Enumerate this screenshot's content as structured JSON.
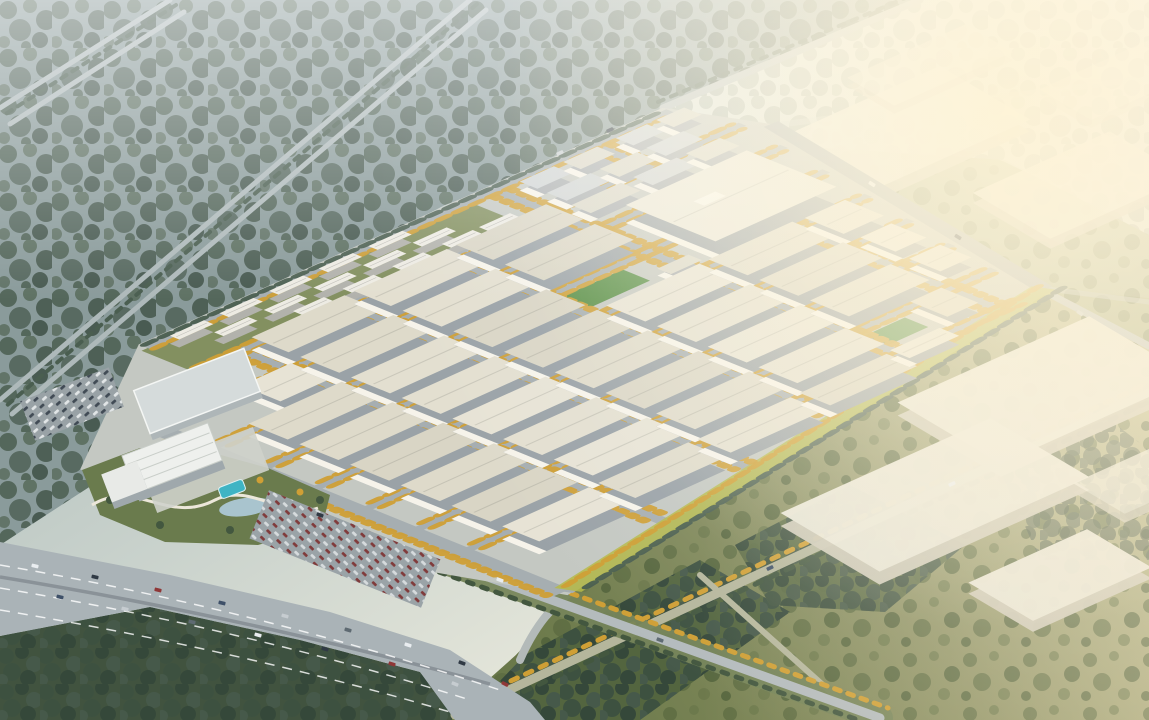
{
  "scene": {
    "description": "Aerial architectural rendering of a large industrial logistics park at hazy golden hour: grid of white warehouses with autumn street trees, residential slab apartments along the northwest edge, a hotel-office complex with pool and landscaped park at the west corner, a multi-lane highway in the foreground, misty forest to the upper left and sunlit fields with distant warehouses to the right.",
    "palette": {
      "forestBase": "#8a9b9b",
      "treeDark": "#4a5e50",
      "parkGround": "#c4c8c2",
      "street": "#a6aeb1",
      "gold": "#cf9f35",
      "chartreuse": "#b6ba48",
      "pitch": "#4e8a3d",
      "resGreen": "#7d8b58",
      "highway": "#aab3b7",
      "road": "#b4bbbd",
      "pool": "#3fb4c4",
      "sunFace": "#f6f3ea",
      "boxRoof": "#ebe8da",
      "boxFace": "#cdc9b8",
      "fieldDark": "#53653f",
      "sunGlow": "#fff5d7",
      "bld": {
        "w": {
          "name": "warehouse-building",
          "face": "#9aa2a7",
          "sun": 1,
          "roofs": [
            "#e7e3d5",
            "#dedaca",
            "#e3dfd0",
            "#d9d5c5"
          ]
        },
        "W": {
          "name": "large-warehouse-building",
          "face": "#9aa2a7",
          "sun": 1,
          "roofs": [
            "#eae7da"
          ]
        },
        "s": {
          "name": "office-building",
          "face": "#a7acb0",
          "sun": 1,
          "roofs": [
            "#d8d6c9",
            "#cdd2d4"
          ]
        },
        "r": {
          "name": "apartment-building",
          "face": "#b2b2ac",
          "sun": 0,
          "roofs": [
            "#edebe3"
          ]
        }
      }
    },
    "park": {
      "matrix": [
        62,
        -28,
        39,
        15.8,
        160,
        430
      ],
      "ground": "1.45,-2.85 9.9,-2.85 10.45,-0.8 9.35,7.8 0,10.45 -1.45,4.3 -1.35,0.1",
      "streetsU": [
        [
          -2.62,
          1.45,
          9.9,
          0.27
        ],
        [
          -1.28,
          1.3,
          10.2,
          0.2
        ],
        [
          -0.05,
          0.1,
          10.1,
          0.2
        ],
        [
          1.25,
          0.1,
          9.96,
          0.2
        ],
        [
          2.55,
          0.1,
          9.82,
          0.2
        ],
        [
          3.85,
          0.1,
          9.68,
          0.2
        ],
        [
          5.15,
          0.1,
          9.53,
          0.2
        ],
        [
          6.45,
          0.1,
          9.39,
          0.2
        ],
        [
          7.75,
          0.1,
          9.04,
          0.2
        ]
      ],
      "streetsV": [
        [
          0.0,
          0.0,
          10.3,
          0.27
        ],
        [
          2.12,
          -1.3,
          9.55,
          0.18
        ],
        [
          3.77,
          -1.3,
          9.12,
          0.18
        ],
        [
          5.42,
          -1.3,
          8.69,
          0.18
        ],
        [
          7.07,
          -2.68,
          8.26,
          0.18
        ],
        [
          8.67,
          -2.68,
          7.8,
          0.18
        ]
      ],
      "lines": [
        [
          10.42,
          -0.9,
          9.4,
          7.75,
          0.22
        ],
        [
          9.45,
          7.75,
          0.05,
          10.35,
          0.22
        ]
      ],
      "bufferLine": [
        9.42,
        7.72,
        0.1,
        10.3
      ],
      "treeLines": [
        [
          9.4,
          7.58,
          0.15,
          10.15,
          "g"
        ],
        [
          9.55,
          7.95,
          0.25,
          10.48,
          "d"
        ],
        [
          -0.16,
          0.4,
          -0.16,
          10.2,
          "g"
        ],
        [
          1.5,
          -2.52,
          9.8,
          -2.52,
          "g"
        ],
        [
          1.5,
          -2.76,
          9.85,
          -2.76,
          "d"
        ]
      ],
      "greens": [
        [
          1.35,
          -2.62,
          5.3,
          1.34,
          "g"
        ],
        [
          5.6,
          1.45,
          0.95,
          0.7,
          "p"
        ],
        [
          7.05,
          6.7,
          0.75,
          0.6,
          "p"
        ]
      ],
      "buildings": [
        [
          "r",
          1.7,
          -2.45,
          0.55,
          0.24,
          8
        ],
        [
          "r",
          2.5,
          -2.45,
          0.55,
          0.24,
          8
        ],
        [
          "r",
          3.3,
          -2.45,
          0.55,
          0.24,
          8
        ],
        [
          "r",
          4.1,
          -2.45,
          0.55,
          0.24,
          8
        ],
        [
          "r",
          4.9,
          -2.45,
          0.55,
          0.24,
          8
        ],
        [
          "r",
          2.1,
          -1.95,
          0.55,
          0.24,
          8
        ],
        [
          "r",
          2.9,
          -1.95,
          0.55,
          0.24,
          8
        ],
        [
          "r",
          3.7,
          -1.95,
          0.55,
          0.24,
          8
        ],
        [
          "r",
          4.5,
          -1.95,
          0.55,
          0.24,
          8
        ],
        [
          "r",
          5.3,
          -1.95,
          0.55,
          0.24,
          8
        ],
        [
          "r",
          3.1,
          -1.52,
          0.5,
          0.24,
          8
        ],
        [
          "r",
          3.9,
          -1.52,
          0.5,
          0.24,
          8
        ],
        [
          "r",
          4.7,
          -1.52,
          0.5,
          0.24,
          8
        ],
        [
          "r",
          5.5,
          -1.52,
          0.5,
          0.24,
          8
        ],
        [
          "r",
          6.1,
          -1.52,
          0.5,
          0.24,
          8
        ],
        [
          "s",
          7.25,
          -2.3,
          0.55,
          0.45,
          9
        ],
        [
          "s",
          7.95,
          -2.3,
          0.55,
          0.45,
          9
        ],
        [
          "s",
          8.8,
          -2.3,
          0.5,
          0.45,
          9
        ],
        [
          "s",
          9.45,
          -2.3,
          0.45,
          0.45,
          9
        ],
        [
          "s",
          7.25,
          -1.6,
          0.7,
          0.5,
          9
        ],
        [
          "s",
          8.1,
          -1.6,
          0.6,
          0.5,
          9
        ],
        [
          "s",
          8.85,
          -1.6,
          0.6,
          0.5,
          9
        ],
        [
          "s",
          7.2,
          -0.9,
          0.8,
          0.5,
          9
        ],
        [
          "s",
          8.2,
          -0.9,
          0.7,
          0.5,
          9
        ],
        [
          "s",
          9.05,
          -0.9,
          0.55,
          0.5,
          9
        ],
        [
          "w",
          2.2,
          -1.15,
          1.5,
          0.95,
          13
        ],
        [
          "w",
          3.85,
          -1.15,
          1.5,
          0.95,
          13
        ],
        [
          "w",
          5.5,
          -1.15,
          1.45,
          0.95,
          13
        ],
        [
          "w",
          1.25,
          0.1,
          0.8,
          1.0,
          11
        ],
        [
          "w",
          2.2,
          0.1,
          1.5,
          1.0,
          13
        ],
        [
          "w",
          3.85,
          0.1,
          1.5,
          1.0,
          13
        ],
        [
          "w",
          5.5,
          0.1,
          1.45,
          1.0,
          13
        ],
        [
          "W",
          7.45,
          0.1,
          1.95,
          2.3,
          18
        ],
        [
          "w",
          0.55,
          1.4,
          1.5,
          1.0,
          13
        ],
        [
          "w",
          2.2,
          1.4,
          1.5,
          1.0,
          13
        ],
        [
          "w",
          3.85,
          1.4,
          1.5,
          1.0,
          13
        ],
        [
          "s",
          6.7,
          2.1,
          0.5,
          0.35,
          7
        ],
        [
          "w",
          0.55,
          2.7,
          1.5,
          1.0,
          13
        ],
        [
          "w",
          2.2,
          2.7,
          1.5,
          1.0,
          13
        ],
        [
          "w",
          3.85,
          2.7,
          1.5,
          1.0,
          13
        ],
        [
          "w",
          5.5,
          2.7,
          1.5,
          1.0,
          13
        ],
        [
          "w",
          7.15,
          2.7,
          1.35,
          1.0,
          13
        ],
        [
          "w",
          8.7,
          2.7,
          0.65,
          1.0,
          11
        ],
        [
          "w",
          0.55,
          4.0,
          1.5,
          1.0,
          13
        ],
        [
          "w",
          2.2,
          4.0,
          1.5,
          1.0,
          13
        ],
        [
          "w",
          3.85,
          4.0,
          1.5,
          1.0,
          13
        ],
        [
          "w",
          5.5,
          4.0,
          1.5,
          1.0,
          13
        ],
        [
          "w",
          7.15,
          4.0,
          1.35,
          1.0,
          13
        ],
        [
          "w",
          8.78,
          4.0,
          0.5,
          0.9,
          10
        ],
        [
          "w",
          0.55,
          5.3,
          1.5,
          1.0,
          13
        ],
        [
          "w",
          2.2,
          5.3,
          1.5,
          1.0,
          13
        ],
        [
          "w",
          3.85,
          5.3,
          1.5,
          1.0,
          13
        ],
        [
          "w",
          5.5,
          5.3,
          1.5,
          1.0,
          13
        ],
        [
          "w",
          7.15,
          5.3,
          1.3,
          1.0,
          13
        ],
        [
          "w",
          8.75,
          5.3,
          0.5,
          0.8,
          10
        ],
        [
          "w",
          0.55,
          6.6,
          1.4,
          1.0,
          13
        ],
        [
          "w",
          2.2,
          6.6,
          1.5,
          1.0,
          13
        ],
        [
          "w",
          3.85,
          6.6,
          1.5,
          1.0,
          13
        ],
        [
          "w",
          5.5,
          6.6,
          1.4,
          1.0,
          13
        ],
        [
          "w",
          7.95,
          6.6,
          0.5,
          0.95,
          10
        ],
        [
          "w",
          0.55,
          7.9,
          1.4,
          0.95,
          13
        ],
        [
          "w",
          2.1,
          7.9,
          1.45,
          0.95,
          13
        ],
        [
          "w",
          3.7,
          7.9,
          1.5,
          0.85,
          12
        ],
        [
          "w",
          5.35,
          7.9,
          1.4,
          0.78,
          12
        ],
        [
          "w",
          6.9,
          7.75,
          0.8,
          0.5,
          9
        ]
      ]
    },
    "rightBoxes": [
      [
        880,
        140,
        230,
        105,
        12,
        0.92
      ],
      [
        1080,
        185,
        150,
        90,
        10,
        0.85
      ],
      [
        930,
        65,
        130,
        55,
        8,
        0.6
      ],
      [
        1120,
        80,
        120,
        60,
        8,
        0.55
      ],
      [
        1045,
        390,
        210,
        120,
        13,
        0.96
      ],
      [
        935,
        495,
        230,
        115,
        13,
        0.96
      ],
      [
        1060,
        575,
        130,
        75,
        11,
        0.95
      ],
      [
        1140,
        480,
        90,
        60,
        9,
        0.8
      ]
    ],
    "carColors": [
      "#e9edf0",
      "#303a45",
      "#8f3737",
      "#3e5068",
      "#c6ccd0",
      "#5e6a72"
    ],
    "cars": [
      [
        35,
        566,
        13,
        0
      ],
      [
        95,
        577,
        13,
        1
      ],
      [
        158,
        590,
        14,
        2
      ],
      [
        222,
        603,
        14,
        3
      ],
      [
        285,
        616,
        15,
        4
      ],
      [
        348,
        630,
        16,
        5
      ],
      [
        408,
        645,
        17,
        0
      ],
      [
        462,
        663,
        20,
        1
      ],
      [
        505,
        684,
        26,
        2
      ],
      [
        60,
        597,
        13,
        3
      ],
      [
        125,
        609,
        13,
        4
      ],
      [
        192,
        622,
        14,
        5
      ],
      [
        258,
        635,
        15,
        0
      ],
      [
        325,
        649,
        16,
        1
      ],
      [
        392,
        664,
        18,
        2
      ],
      [
        455,
        684,
        22,
        4
      ],
      [
        320,
        515,
        20,
        1
      ],
      [
        500,
        580,
        20,
        0
      ],
      [
        660,
        640,
        20,
        5
      ],
      [
        872,
        184,
        32,
        0
      ],
      [
        958,
        237,
        32,
        1
      ],
      [
        1080,
        313,
        32,
        4
      ],
      [
        770,
        568,
        -25,
        3
      ],
      [
        952,
        484,
        -25,
        0
      ],
      [
        560,
        153,
        -25,
        4
      ],
      [
        610,
        130,
        -25,
        1
      ]
    ]
  }
}
